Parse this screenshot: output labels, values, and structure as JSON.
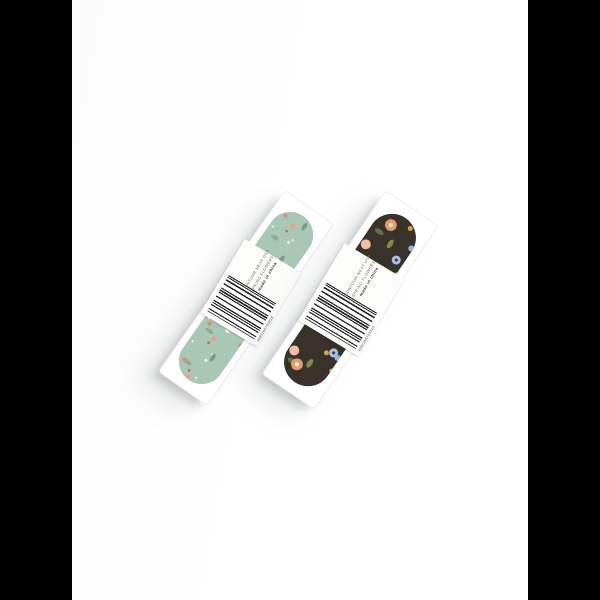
{
  "image": {
    "type": "product-photo",
    "canvas": {
      "pillarbox_color": "#000000",
      "photo_background": "#ffffff"
    },
    "products": [
      {
        "id": "item-left",
        "pattern": "mint-ditsy-floral",
        "print_colors": {
          "base": "#a9c7b5",
          "coral": "#e2886d",
          "cream": "#f4f1e2",
          "leaf": "#7e968b",
          "berry": "#c9645a"
        },
        "sticker": {
          "line1": "CONTOUR NEXT USB",
          "line2": "SPRING FLOWERS",
          "line3_bold": "made in china",
          "barcode_digits": "4680265703323"
        }
      },
      {
        "id": "item-right",
        "pattern": "dark-meadow-floral",
        "print_colors": {
          "base": "#38322a",
          "orange": "#e89a6a",
          "blue": "#a4c3e8",
          "peach": "#f2bfa0",
          "yellow": "#d8a23c",
          "leaf": "#7c8c49"
        },
        "sticker": {
          "line1": "CONTOUR NEXT USB",
          "line2": "SPRING FLOWERS",
          "line3_bold": "made in china",
          "barcode_digits": "4680265703323"
        }
      }
    ]
  }
}
